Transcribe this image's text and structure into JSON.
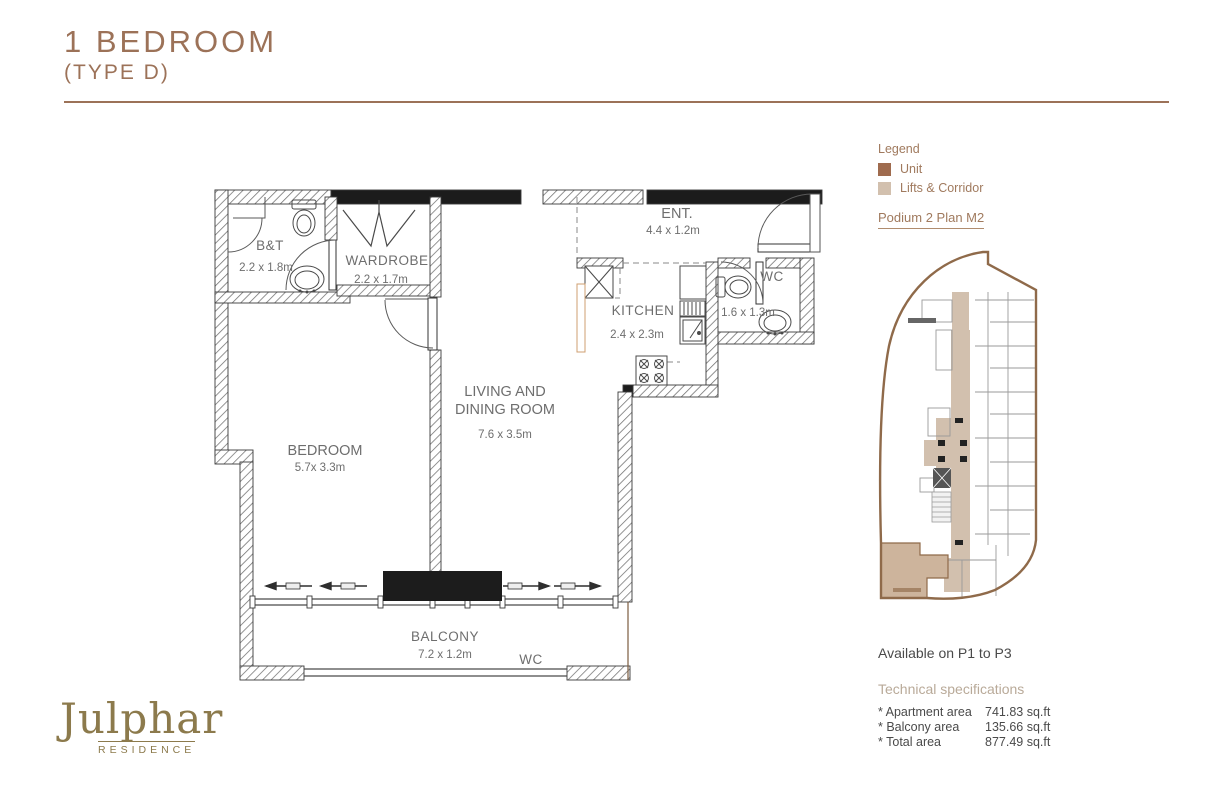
{
  "title": {
    "line1": "1 BEDROOM",
    "line2": "(TYPE D)"
  },
  "logo": {
    "name": "Julphar",
    "sub": "RESIDENCE"
  },
  "legend": {
    "heading": "Legend",
    "items": [
      {
        "label": "Unit",
        "color": "#9f6b4e"
      },
      {
        "label": "Lifts & Corridor",
        "color": "#d2c0ae"
      }
    ],
    "plan_ref": "Podium 2 Plan M2"
  },
  "availability": "Available on P1  to P3",
  "specs": {
    "heading": "Technical specifications",
    "rows": [
      {
        "label": "* Apartment area",
        "value": "741.83 sq.ft"
      },
      {
        "label": "* Balcony area",
        "value": "135.66 sq.ft"
      },
      {
        "label": "* Total area",
        "value": "877.49 sq.ft"
      }
    ]
  },
  "plan": {
    "bt": {
      "name": "B&T",
      "dim": "2.2 x 1.8m"
    },
    "wardrobe": {
      "name": "WARDROBE",
      "dim": "2.2 x 1.7m"
    },
    "ent": {
      "name": "ENT.",
      "dim": "4.4 x 1.2m"
    },
    "kitchen": {
      "name": "KITCHEN",
      "dim": "2.4 x 2.3m"
    },
    "wc": {
      "name": "WC",
      "dim": "1.6 x 1.3m"
    },
    "bedroom": {
      "name": "BEDROOM",
      "dim": "5.7x 3.3m"
    },
    "living": {
      "name1": "LIVING AND",
      "name2": "DINING ROOM",
      "dim": "7.6 x 3.5m"
    },
    "balcony": {
      "name": "BALCONY",
      "dim": "7.2 x 1.2m",
      "extra": "WC"
    }
  },
  "colors": {
    "unit": "#9f6b4e",
    "corridor": "#d2c0ae",
    "outline": "#8f6a4a",
    "accent": "#9c7258"
  }
}
